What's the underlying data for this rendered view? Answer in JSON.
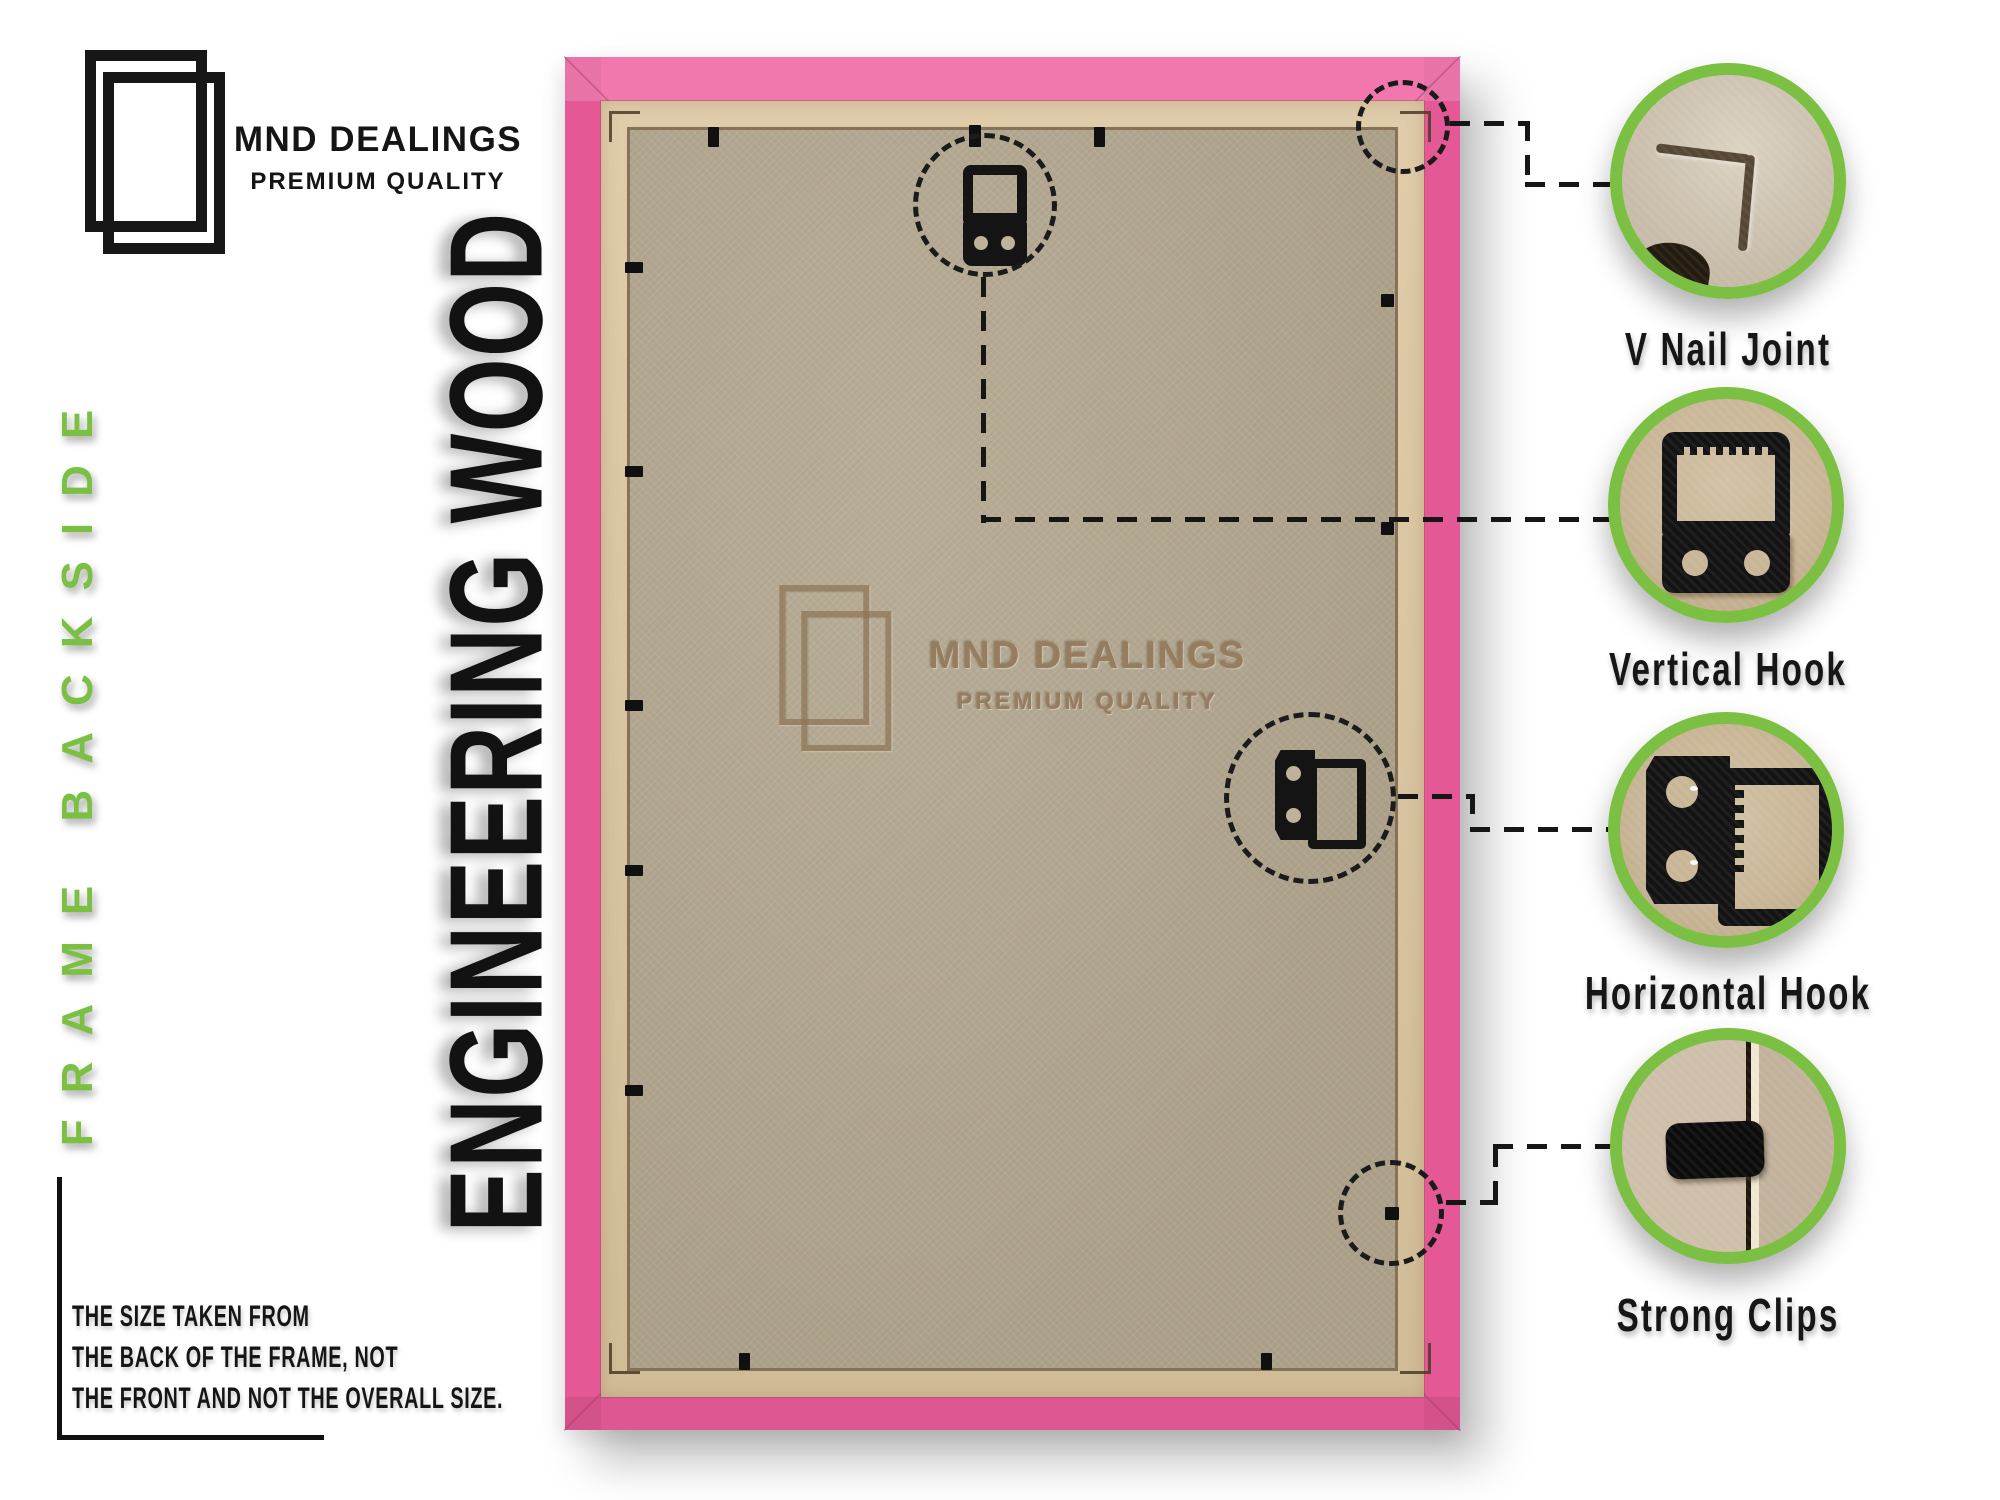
{
  "brand": {
    "name": "MND DEALINGS",
    "tagline": "PREMIUM QUALITY"
  },
  "side_label": "FRAME BACKSIDE",
  "material_label": "ENGINEERING WOOD",
  "watermark": {
    "name": "MND DEALINGS",
    "tagline": "PREMIUM QUALITY"
  },
  "callouts": [
    {
      "id": "v-nail-joint",
      "label": "V Nail Joint"
    },
    {
      "id": "vertical-hook",
      "label": "Vertical Hook"
    },
    {
      "id": "horizontal-hook",
      "label": "Horizontal Hook"
    },
    {
      "id": "strong-clips",
      "label": "Strong Clips"
    }
  ],
  "note": {
    "line1": "THE SIZE TAKEN FROM",
    "line2": "THE BACK OF THE FRAME, NOT",
    "line3": "THE FRONT AND NOT THE OVERALL SIZE."
  },
  "colors": {
    "frame_pink": "#EF5D9D",
    "accent_green": "#7CC043",
    "mdf_board": "#B3A78F",
    "wood_strip": "#DCC6A0",
    "text_black": "#161616"
  }
}
